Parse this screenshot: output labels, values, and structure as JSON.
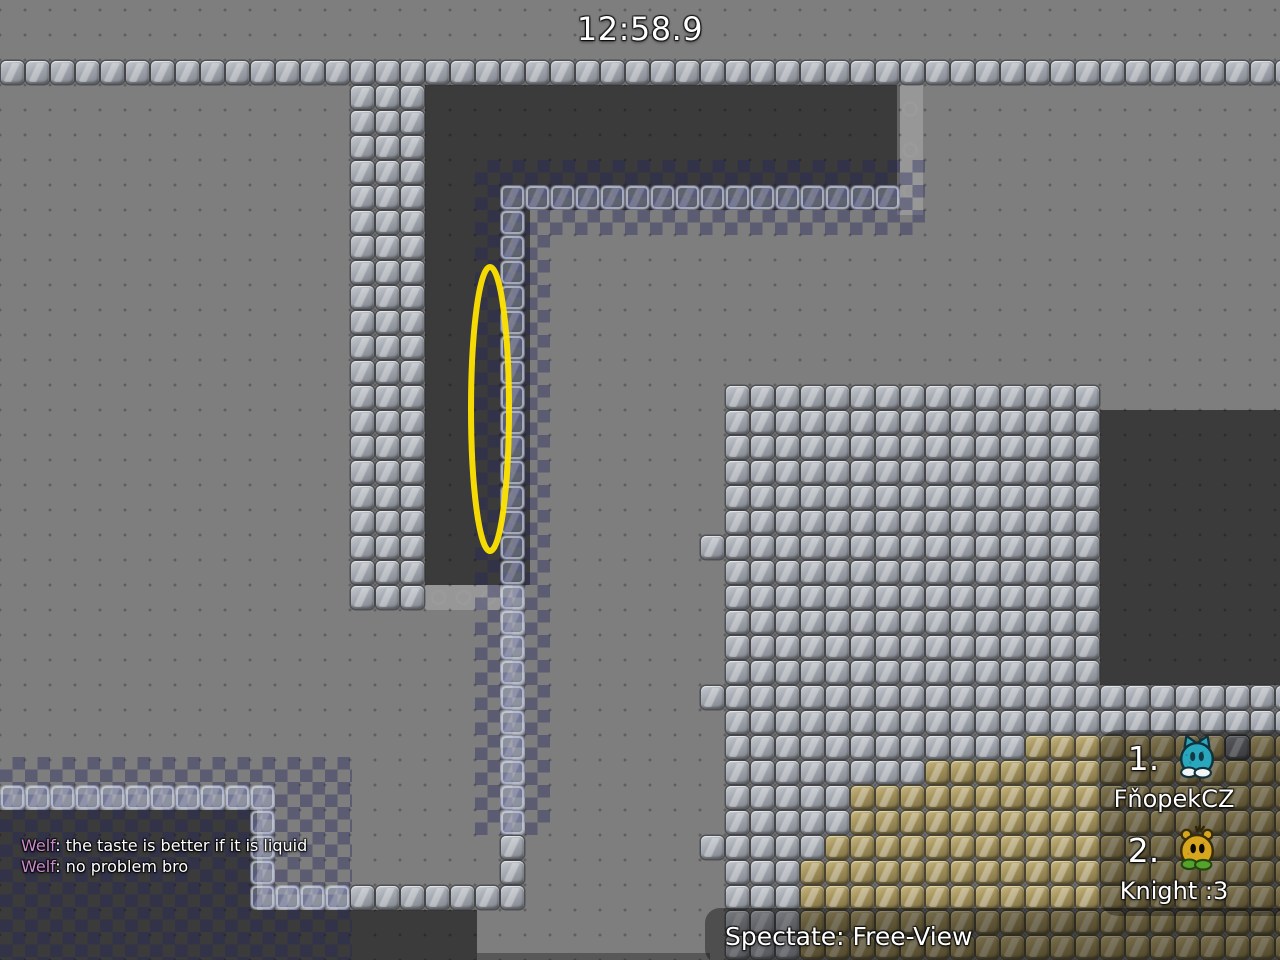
{
  "hud": {
    "timer": "12:58.9",
    "chat": [
      {
        "name": "Welf",
        "text": ": the taste is better if it is liquid"
      },
      {
        "name": "Welf",
        "text": ": no problem bro"
      }
    ],
    "scoreboard": {
      "entries": [
        {
          "rank": "1.",
          "name": "FňopekCZ",
          "tee": "cyan-cat-tee"
        },
        {
          "rank": "2.",
          "name": "Knight :3",
          "tee": "gold-bear-tee"
        }
      ]
    },
    "spectate_label": "Spectate: Free-View"
  },
  "colors": {
    "background": "#7e7e7e",
    "dark_area": "#3b3b3b",
    "checker_overlay": "rgba(35,35,95,0.38)",
    "chat_name": "#c98bcd",
    "ellipse_stroke": "#ffe400",
    "metal_tile": "#a4a8b0",
    "dirt_tile": "#a5935c",
    "glass_tile": "rgba(178,192,232,0.3)",
    "tee1_body": "#29a7bd",
    "tee1_feet": "#f2f6f7",
    "tee2_body": "#d8a51e",
    "tee2_feet": "#55a22c"
  },
  "map": {
    "tile_size": 25,
    "origin_y": 60,
    "regions": [
      {
        "v": "metal",
        "c": 0,
        "r": 0,
        "w": 52,
        "h": 1
      },
      {
        "v": "metal",
        "c": 14,
        "r": 1,
        "w": 3,
        "h": 21
      },
      {
        "v": "glass",
        "c": 20,
        "r": 5,
        "w": 16,
        "h": 1
      },
      {
        "v": "glass",
        "c": 20,
        "r": 6,
        "w": 1,
        "h": 25
      },
      {
        "v": "metal",
        "c": 20,
        "r": 31,
        "w": 1,
        "h": 2
      },
      {
        "v": "glass",
        "c": 0,
        "r": 29,
        "w": 11,
        "h": 1
      },
      {
        "v": "glass",
        "c": 10,
        "r": 30,
        "w": 1,
        "h": 3
      },
      {
        "v": "glass",
        "c": 10,
        "r": 33,
        "w": 4,
        "h": 1
      },
      {
        "v": "metal",
        "c": 14,
        "r": 33,
        "w": 7,
        "h": 1
      },
      {
        "v": "metal",
        "c": 29,
        "r": 13,
        "w": 15,
        "h": 12
      },
      {
        "v": "metal",
        "c": 29,
        "r": 25,
        "w": 23,
        "h": 2
      },
      {
        "v": "metal",
        "c": 28,
        "r": 19,
        "w": 1,
        "h": 1
      },
      {
        "v": "metal",
        "c": 28,
        "r": 25,
        "w": 1,
        "h": 1
      },
      {
        "v": "metal",
        "c": 28,
        "r": 31,
        "w": 1,
        "h": 1
      },
      {
        "v": "metal",
        "c": 29,
        "r": 27,
        "w": 12,
        "h": 1
      },
      {
        "v": "tan",
        "c": 41,
        "r": 27,
        "w": 11,
        "h": 1
      },
      {
        "v": "darktile",
        "c": 49,
        "r": 27,
        "w": 1,
        "h": 1
      },
      {
        "v": "metal",
        "c": 29,
        "r": 28,
        "w": 8,
        "h": 1
      },
      {
        "v": "tan",
        "c": 37,
        "r": 28,
        "w": 15,
        "h": 1
      },
      {
        "v": "metal",
        "c": 29,
        "r": 29,
        "w": 5,
        "h": 2
      },
      {
        "v": "tan",
        "c": 34,
        "r": 29,
        "w": 18,
        "h": 2
      },
      {
        "v": "metal",
        "c": 29,
        "r": 31,
        "w": 4,
        "h": 1
      },
      {
        "v": "tan",
        "c": 33,
        "r": 31,
        "w": 19,
        "h": 1
      },
      {
        "v": "metal",
        "c": 29,
        "r": 32,
        "w": 3,
        "h": 4
      },
      {
        "v": "tan",
        "c": 32,
        "r": 32,
        "w": 20,
        "h": 4
      }
    ],
    "dark_rects": [
      {
        "x": 425,
        "y": 85,
        "w": 475,
        "h": 125
      },
      {
        "x": 425,
        "y": 210,
        "w": 105,
        "h": 375
      },
      {
        "x": 1100,
        "y": 410,
        "w": 180,
        "h": 275
      },
      {
        "x": 0,
        "y": 810,
        "w": 257,
        "h": 150
      },
      {
        "x": 0,
        "y": 910,
        "w": 477,
        "h": 50
      }
    ],
    "light_strips": [
      {
        "x": 425,
        "y": 585,
        "w": 77,
        "h": 25
      },
      {
        "x": 897,
        "y": 85,
        "w": 26,
        "h": 130
      }
    ],
    "edge_rects": [
      {
        "x": 477,
        "y": 953,
        "w": 233,
        "h": 7
      }
    ],
    "checker_rects": [
      {
        "x": 475,
        "y": 160,
        "w": 450,
        "h": 75
      },
      {
        "x": 475,
        "y": 235,
        "w": 75,
        "h": 600
      },
      {
        "x": 0,
        "y": 757,
        "w": 352,
        "h": 203
      }
    ],
    "ellipse": {
      "x": 462,
      "y": 258,
      "w": 56,
      "h": 302,
      "rx": 19,
      "ry": 142,
      "stroke_width": 6
    }
  }
}
